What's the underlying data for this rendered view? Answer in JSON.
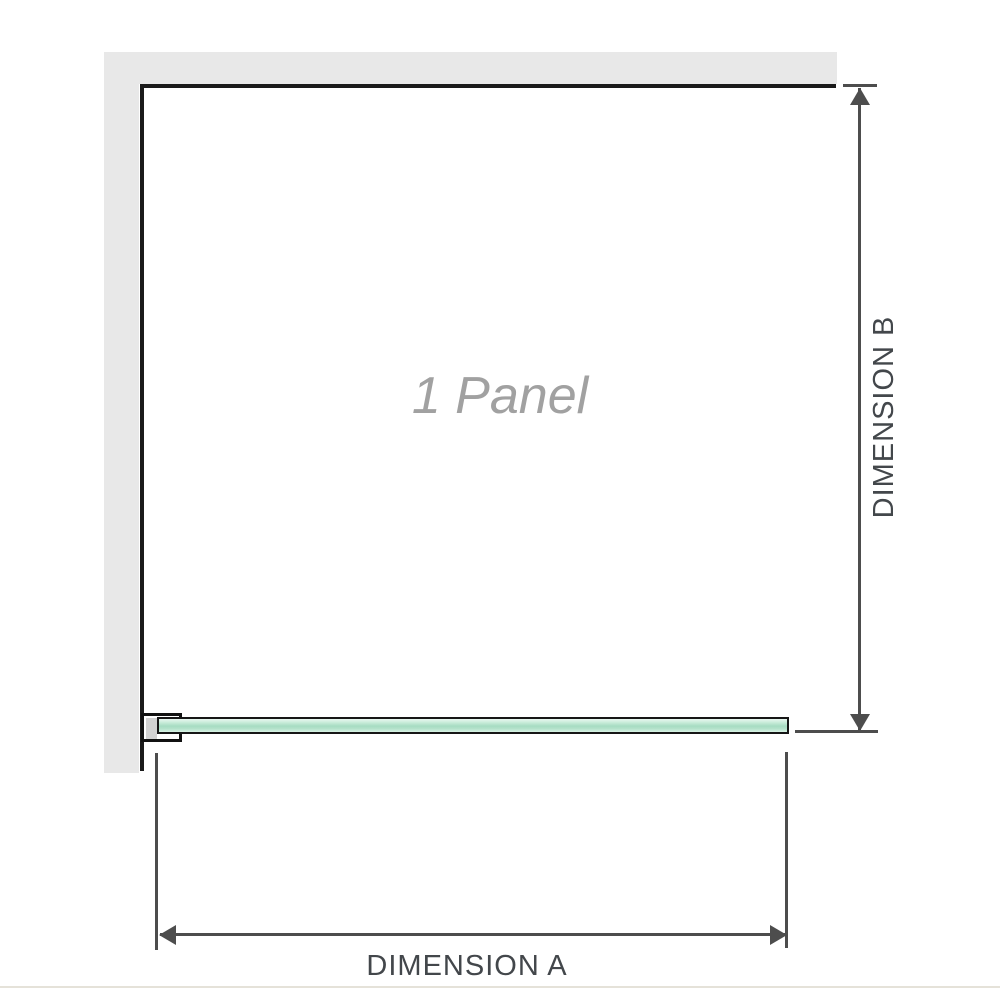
{
  "diagram": {
    "type": "shower-screen-plan-view",
    "panel_label": "1 Panel",
    "dimension_a_label": "DIMENSION A",
    "dimension_b_label": "DIMENSION B"
  },
  "colors": {
    "wall_gray": "#e8e8e8",
    "panel_outline_black": "#1a1a1a",
    "dimension_line_gray": "#4d4d4d",
    "label_text_dark": "#43474b",
    "panel_label_gray": "#a1a1a1",
    "glass_mint_light": "#d9f2e5",
    "glass_mint_mid": "#a6dcc2",
    "bracket_pad_gray": "#d2d2d2",
    "photo_edge_beige": "#e5e2d9"
  },
  "icons": {
    "dim_b_arrow_up": "arrow-up-icon",
    "dim_b_arrow_down": "arrow-down-icon",
    "dim_a_arrow_left": "arrow-left-icon",
    "dim_a_arrow_right": "arrow-right-icon"
  }
}
